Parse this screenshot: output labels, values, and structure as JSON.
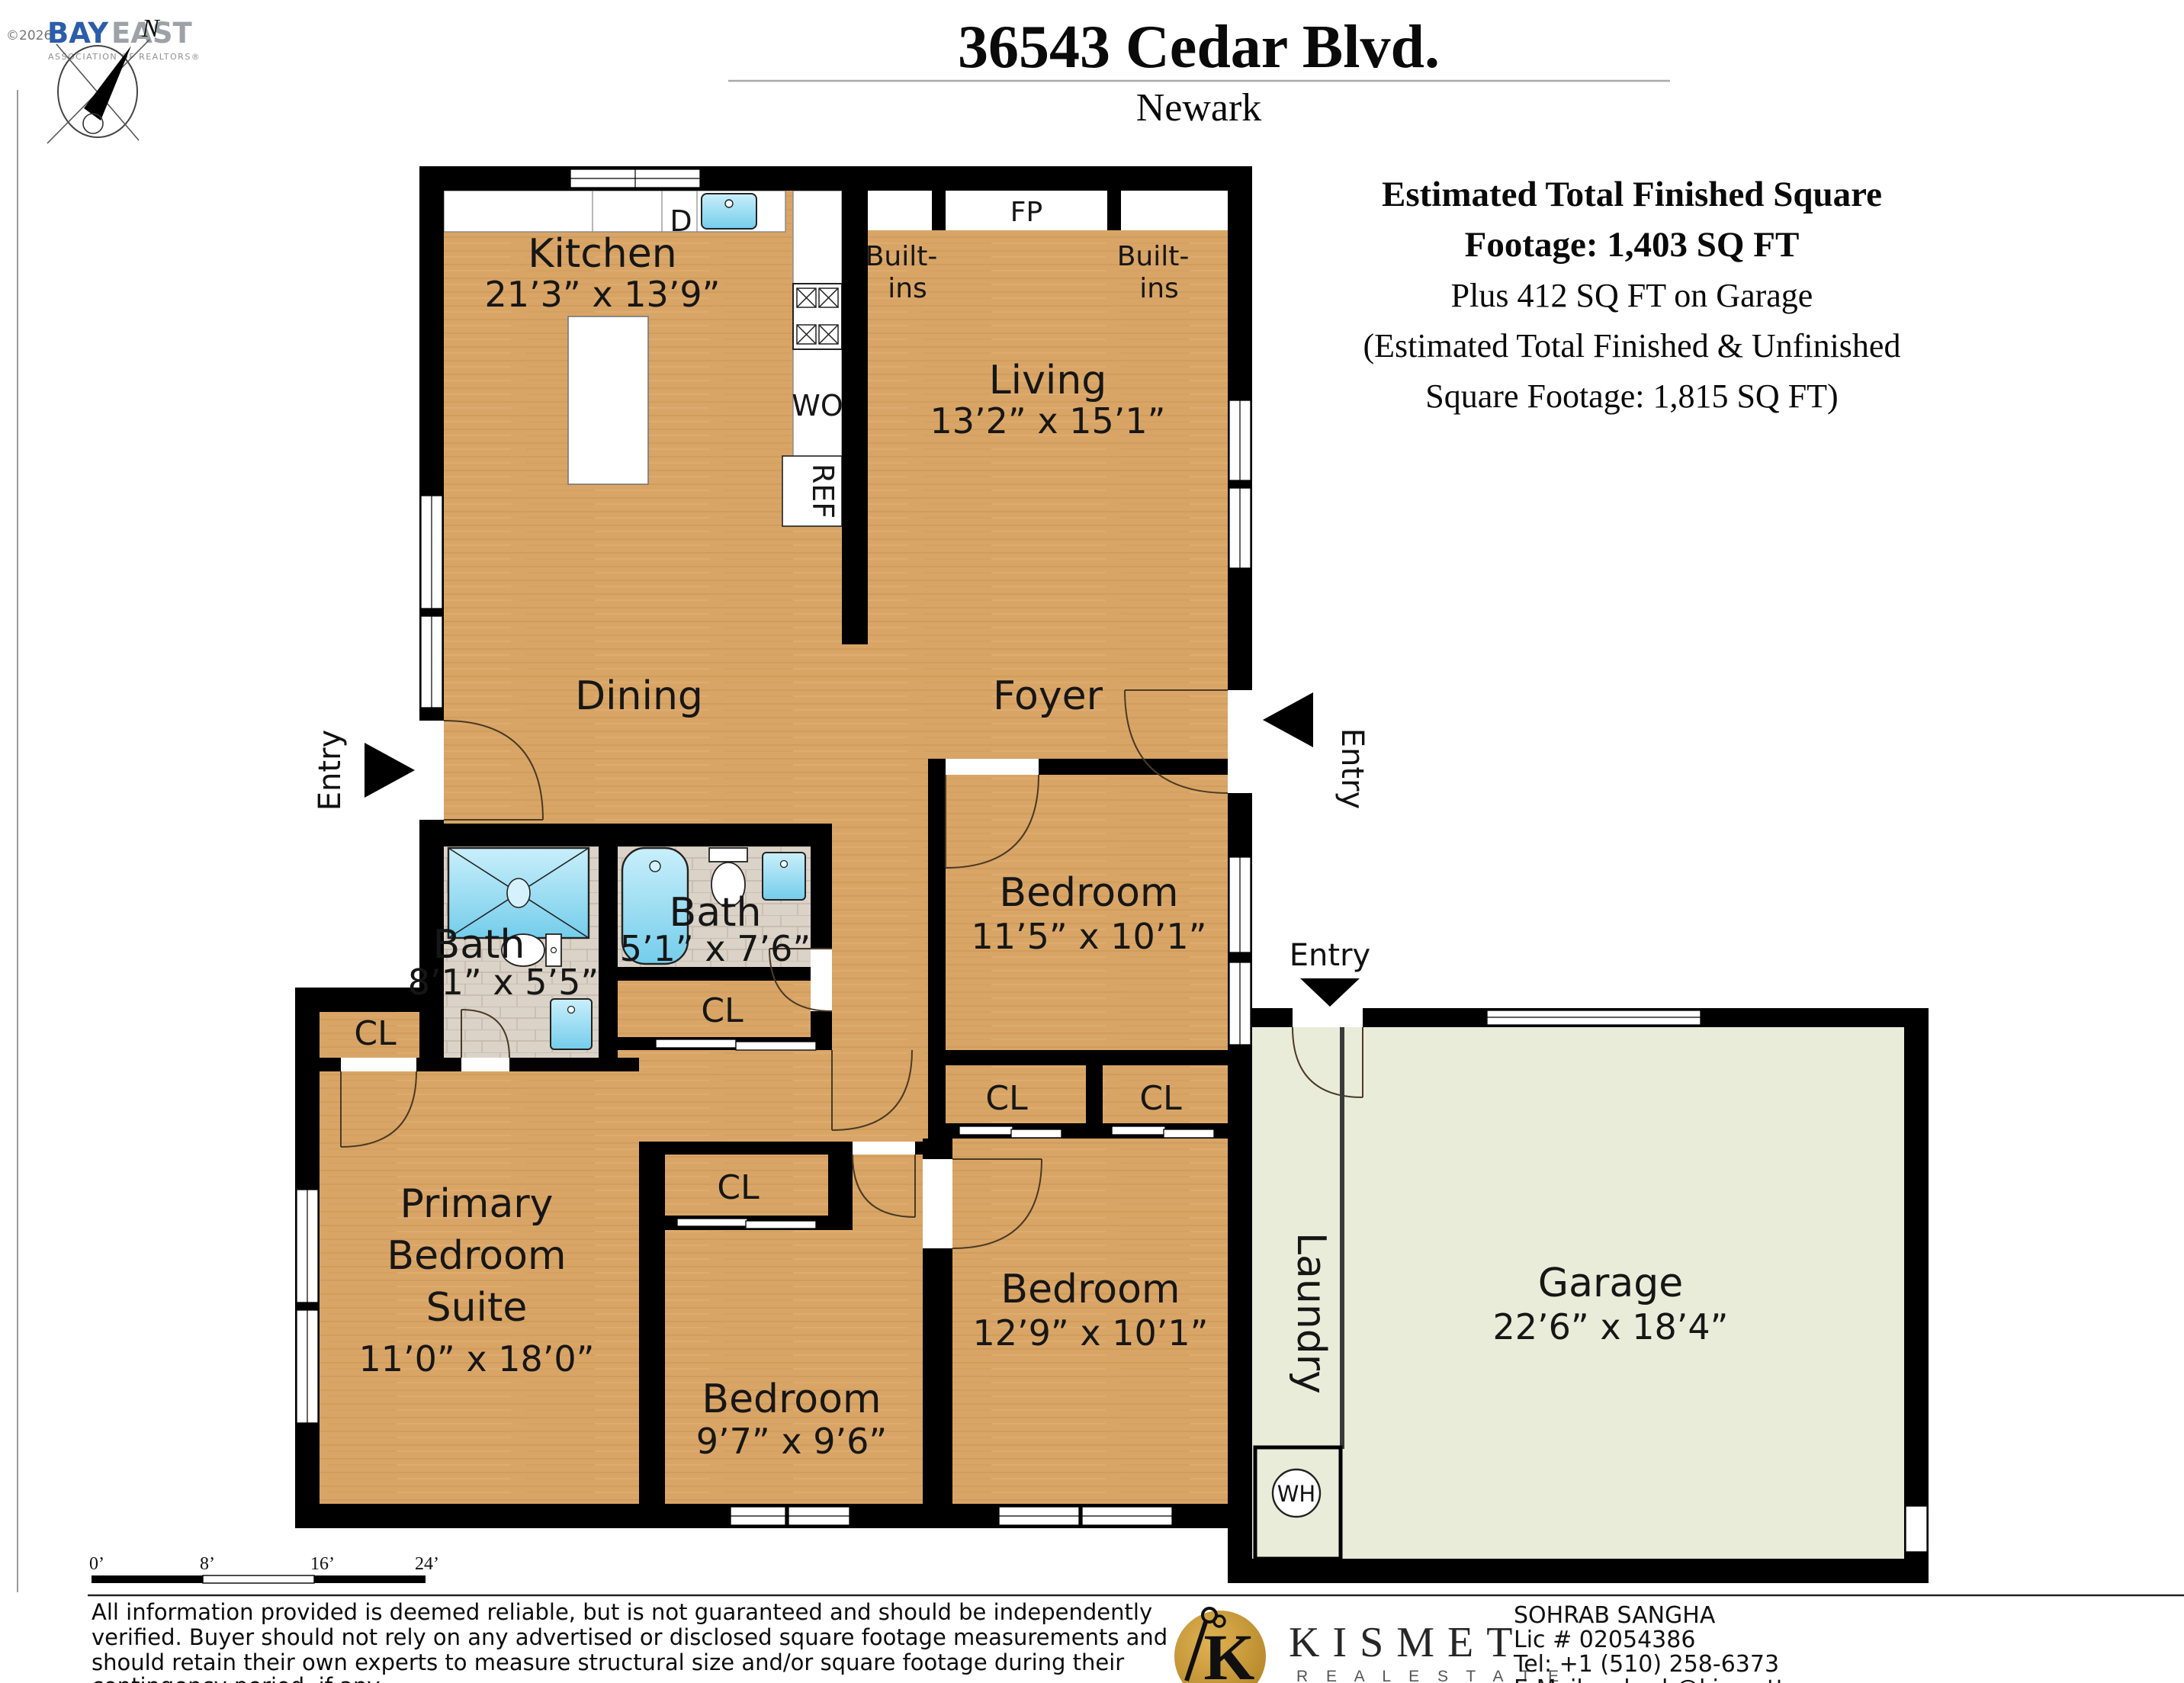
{
  "header": {
    "copyright": "©2026",
    "logo_primary": "BAY",
    "logo_secondary": "EAST",
    "logo_tagline": "ASSOCIATION OF REALTORS®",
    "compass_label": "N",
    "title": "36543 Cedar Blvd.",
    "city": "Newark"
  },
  "summary": {
    "line1": "Estimated Total Finished Square",
    "line2": "Footage: 1,403 SQ FT",
    "line3": "Plus 412 SQ FT on Garage",
    "line4": "(Estimated Total Finished & Unfinished",
    "line5": "Square Footage: 1,815 SQ FT)"
  },
  "plan": {
    "rooms": {
      "kitchen": {
        "name": "Kitchen",
        "dims": "21’3” x 13’9”"
      },
      "living": {
        "name": "Living",
        "dims": "13’2” x 15’1”"
      },
      "dining": {
        "name": "Dining"
      },
      "foyer": {
        "name": "Foyer"
      },
      "bedroom1": {
        "name": "Bedroom",
        "dims": "11’5” x 10’1”"
      },
      "bath_primary": {
        "name": "Bath",
        "dims": "8’1” x 5’5”"
      },
      "bath_hall": {
        "name": "Bath",
        "dims": "5’1” x 7’6”"
      },
      "primary": {
        "name1": "Primary",
        "name2": "Bedroom",
        "name3": "Suite",
        "dims": "11’0” x 18’0”"
      },
      "bedroom2": {
        "name": "Bedroom",
        "dims": "9’7” x 9’6”"
      },
      "bedroom3": {
        "name": "Bedroom",
        "dims": "12’9” x 10’1”"
      },
      "garage": {
        "name": "Garage",
        "dims": "22’6” x 18’4”"
      },
      "laundry": {
        "name": "Laundry"
      }
    },
    "labels": {
      "fireplace": "FP",
      "builtins_line1": "Built-",
      "builtins_line2": "ins",
      "dishwasher": "D",
      "wall_oven": "WO",
      "refrigerator": "REF",
      "closet": "CL",
      "water_heater": "WH",
      "entry": "Entry"
    }
  },
  "scalebar": {
    "t0": "0’",
    "t1": "8’",
    "t2": "16’",
    "t3": "24’"
  },
  "footer": {
    "disclaimer_line1": "All information provided is deemed reliable, but is not guaranteed and should be independently",
    "disclaimer_line2": "verified. Buyer should not rely on any advertised or disclosed square footage measurements and",
    "disclaimer_line3": "should retain their own experts to measure structural size and/or square footage during their",
    "disclaimer_line4": "contingency period, if any.",
    "brand": "KISMET",
    "brand_sub": "R E A L   E S T A T E",
    "agent_name": "SOHRAB SANGHA",
    "agent_license": "Lic # 02054386",
    "agent_phone": "Tel: +1 (510) 258-6373",
    "agent_email": "E-Mail: sohrab@kismetteam.com"
  },
  "colors": {
    "wood": "#d9a566",
    "garage_floor": "#e9ecd9",
    "tile": "#dbd3c8",
    "fixture_blue": "#8fd9f0",
    "wall": "#000000",
    "brand_gold": "#c6942f"
  }
}
